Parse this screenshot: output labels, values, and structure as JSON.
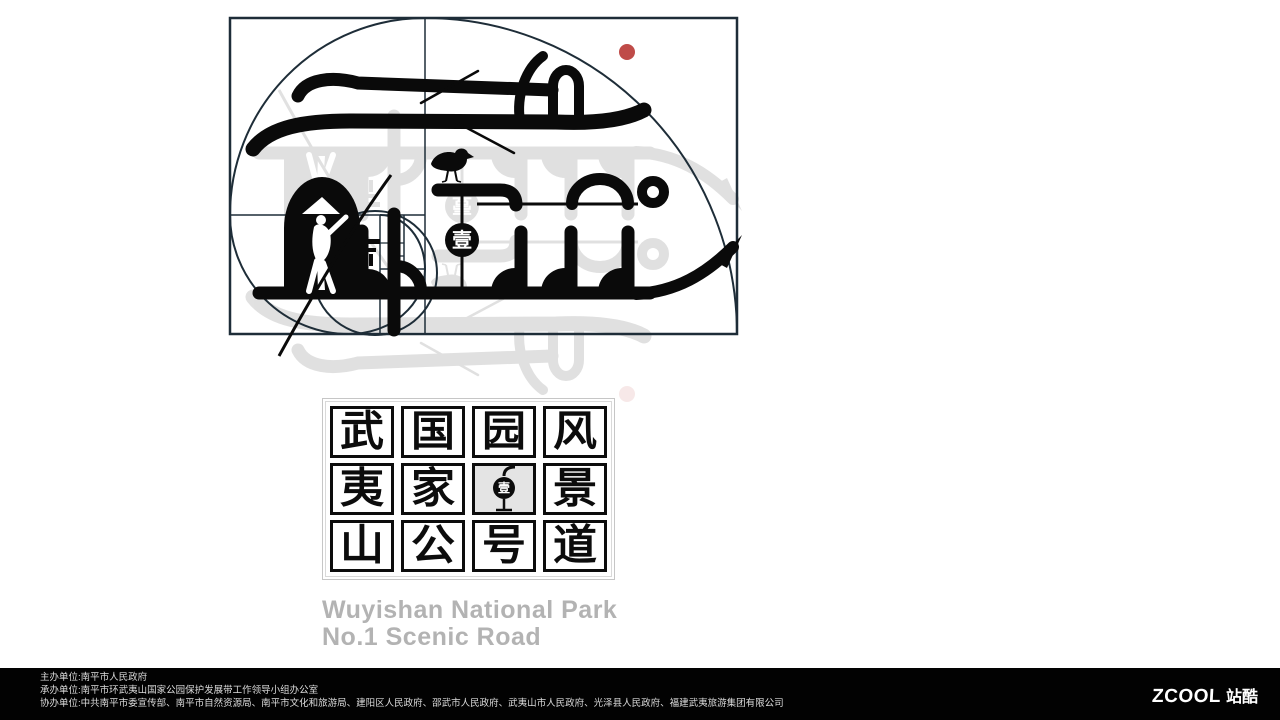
{
  "logo": {
    "lantern_char": "壹",
    "red_dot_color": "#bf4b48",
    "art_color": "#0a0a0a",
    "construction_line_color": "#1e2d38"
  },
  "seal": {
    "lantern_char": "壹",
    "columns": [
      {
        "chars": [
          "武",
          "夷",
          "山"
        ]
      },
      {
        "chars": [
          "国",
          "家",
          "公"
        ]
      },
      {
        "chars": [
          "园",
          "",
          "号"
        ]
      },
      {
        "chars": [
          "风",
          "景",
          "道"
        ]
      }
    ]
  },
  "heading": {
    "line1": "Wuyishan National Park",
    "line2": "No.1 Scenic Road"
  },
  "footer": {
    "lines": [
      "主办单位:南平市人民政府",
      "承办单位:南平市环武夷山国家公园保护发展带工作领导小组办公室",
      "协办单位:中共南平市委宣传部、南平市自然资源局、南平市文化和旅游局、建阳区人民政府、邵武市人民政府、武夷山市人民政府、光泽县人民政府、福建武夷旅游集团有限公司"
    ],
    "brand": {
      "latin": "ZCOOL",
      "cjk": "站酷"
    }
  }
}
